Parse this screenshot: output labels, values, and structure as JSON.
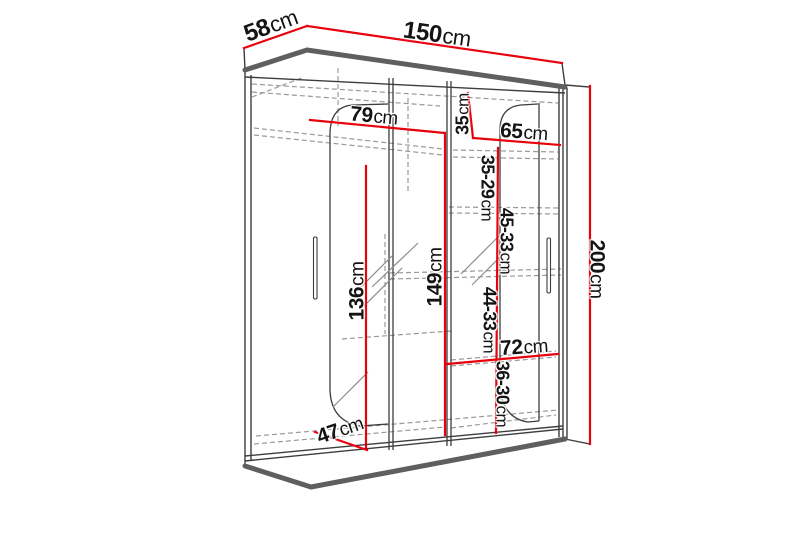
{
  "diagram": {
    "title": "wardrobe-dimension-diagram",
    "colors": {
      "background": "#ffffff",
      "dimension_line": "#e8000d",
      "outline": "#3d3d3d",
      "thick_edge": "#5f5f5f",
      "dashed_line": "#999999",
      "label": "#141414"
    },
    "labels": [
      {
        "id": "depth-top",
        "value": "58",
        "unit": "cm"
      },
      {
        "id": "width-top",
        "value": "150",
        "unit": "cm"
      },
      {
        "id": "height-right",
        "value": "200",
        "unit": "cm"
      },
      {
        "id": "left-rod-width",
        "value": "79",
        "unit": "cm"
      },
      {
        "id": "right-top-shelf-height",
        "value": "35",
        "unit": "cm"
      },
      {
        "id": "right-shelf-width",
        "value": "65",
        "unit": "cm"
      },
      {
        "id": "right-gap-1",
        "value": "35-29",
        "unit": "cm"
      },
      {
        "id": "right-gap-2",
        "value": "45-33",
        "unit": "cm"
      },
      {
        "id": "left-hanging-height",
        "value": "136",
        "unit": "cm"
      },
      {
        "id": "mid-hanging-height",
        "value": "149",
        "unit": "cm"
      },
      {
        "id": "right-gap-3",
        "value": "44-33",
        "unit": "cm"
      },
      {
        "id": "bottom-shelf-width",
        "value": "72",
        "unit": "cm"
      },
      {
        "id": "right-gap-4",
        "value": "36-30",
        "unit": "cm"
      },
      {
        "id": "depth-bottom",
        "value": "47",
        "unit": "cm"
      }
    ]
  }
}
